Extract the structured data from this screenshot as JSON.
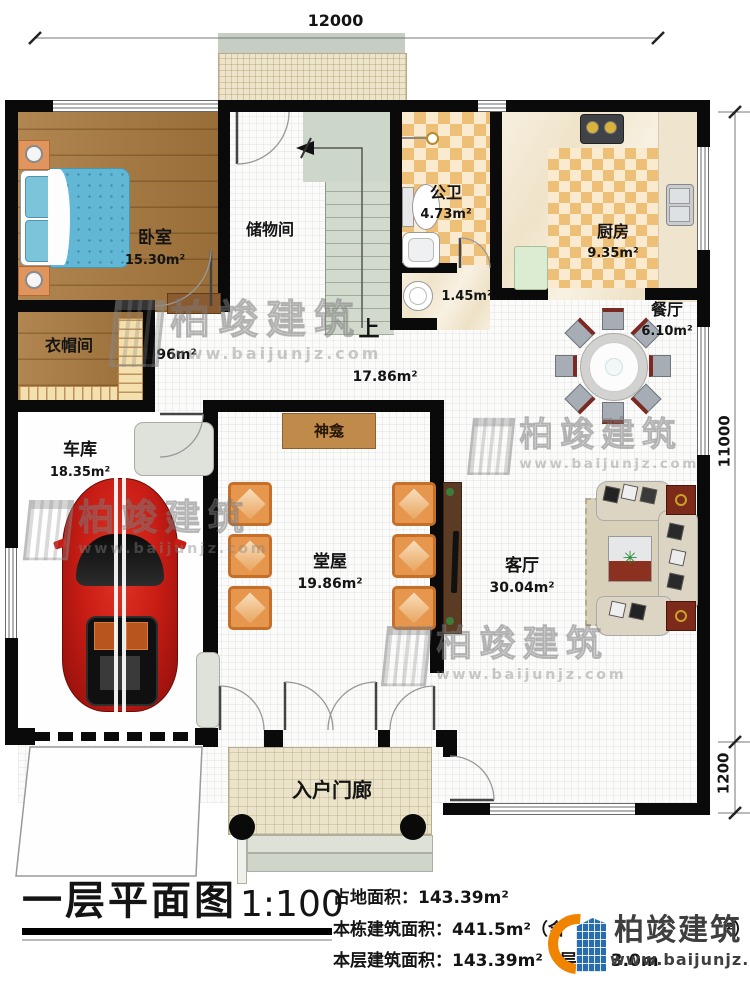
{
  "dimensions": {
    "top": "12000",
    "right_upper": "11000",
    "right_lower": "1200"
  },
  "rooms": {
    "bedroom": {
      "name": "卧室",
      "area": "15.30m²"
    },
    "storage": {
      "name": "储物间"
    },
    "bathroom": {
      "name": "公卫",
      "area": "4.73m²"
    },
    "wash": {
      "area": "1.45m²"
    },
    "kitchen": {
      "name": "厨房",
      "area": "9.35m²"
    },
    "dining": {
      "name": "餐厅",
      "area": "6.10m²"
    },
    "cloak": {
      "name": "衣帽间",
      "area": "1.96m²"
    },
    "hall": {
      "area": "17.86m²"
    },
    "stairs": {
      "up": "上"
    },
    "garage": {
      "name": "车库",
      "area": "18.35m²"
    },
    "shrine": {
      "name": "神龛"
    },
    "main_hall": {
      "name": "堂屋",
      "area": "19.86m²"
    },
    "living": {
      "name": "客厅",
      "area": "30.04m²"
    },
    "porch": {
      "name": "入户门廊"
    }
  },
  "title_block": {
    "title": "一层平面图",
    "scale": "1:100",
    "land_area": "占地面积：143.39m²",
    "building_area": "本栋建筑面积：441.5m²（含",
    "building_area_end": "²）",
    "floor_area": "本层建筑面积：143.39m²",
    "floor_height": "层高：3.0m"
  },
  "brand": {
    "name": "柏竣建筑",
    "url": "www.baijunjz.com",
    "orange": "#f08300",
    "blue": "#2a6cb0"
  }
}
